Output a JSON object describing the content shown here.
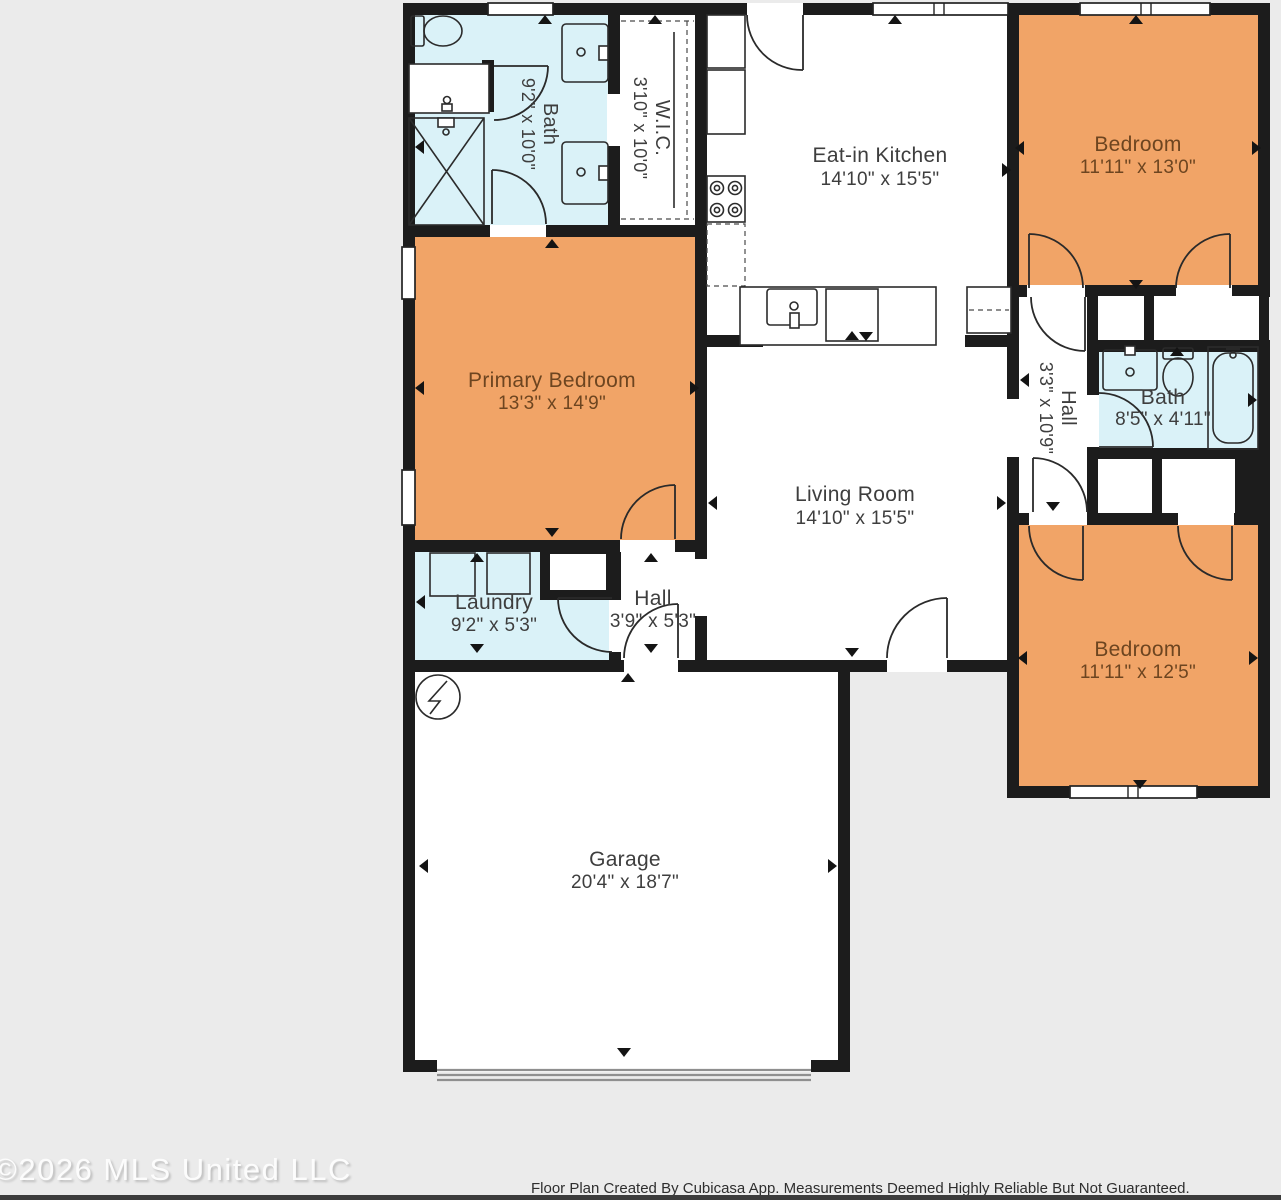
{
  "plan": {
    "rooms": [
      {
        "id": "bath-1",
        "name": "Bath",
        "dims": "9'2\" x 10'0\""
      },
      {
        "id": "wic",
        "name": "W.I.C.",
        "dims": "3'10\" x 10'0\""
      },
      {
        "id": "eat-in-kitchen",
        "name": "Eat-in Kitchen",
        "dims": "14'10\" x 15'5\""
      },
      {
        "id": "bedroom-top-right",
        "name": "Bedroom",
        "dims": "11'11\" x 13'0\""
      },
      {
        "id": "primary-bedroom",
        "name": "Primary Bedroom",
        "dims": "13'3\" x 14'9\""
      },
      {
        "id": "hall-upper",
        "name": "Hall",
        "dims": "3'3\" x 10'9\""
      },
      {
        "id": "bath-2",
        "name": "Bath",
        "dims": "8'5\" x 4'11\""
      },
      {
        "id": "living-room",
        "name": "Living Room",
        "dims": "14'10\" x 15'5\""
      },
      {
        "id": "laundry",
        "name": "Laundry",
        "dims": "9'2\" x 5'3\""
      },
      {
        "id": "hall-lower",
        "name": "Hall",
        "dims": "3'9\" x 5'3\""
      },
      {
        "id": "bedroom-bottom-right",
        "name": "Bedroom",
        "dims": "11'11\" x 12'5\""
      },
      {
        "id": "garage",
        "name": "Garage",
        "dims": "20'4\" x 18'7\""
      }
    ],
    "colors": {
      "bedroom_fill": "#F1A467",
      "wet_room_fill": "#DAF2F8",
      "wall": "#1C1C1C",
      "background": "#EBEBEB",
      "label_text": "#3E3E3E",
      "bedroom_label_text": "#6D4520"
    }
  },
  "footer": {
    "watermark": "©2026 MLS United LLC",
    "disclaimer": "Floor Plan Created By Cubicasa App. Measurements Deemed Highly Reliable But Not Guaranteed."
  }
}
